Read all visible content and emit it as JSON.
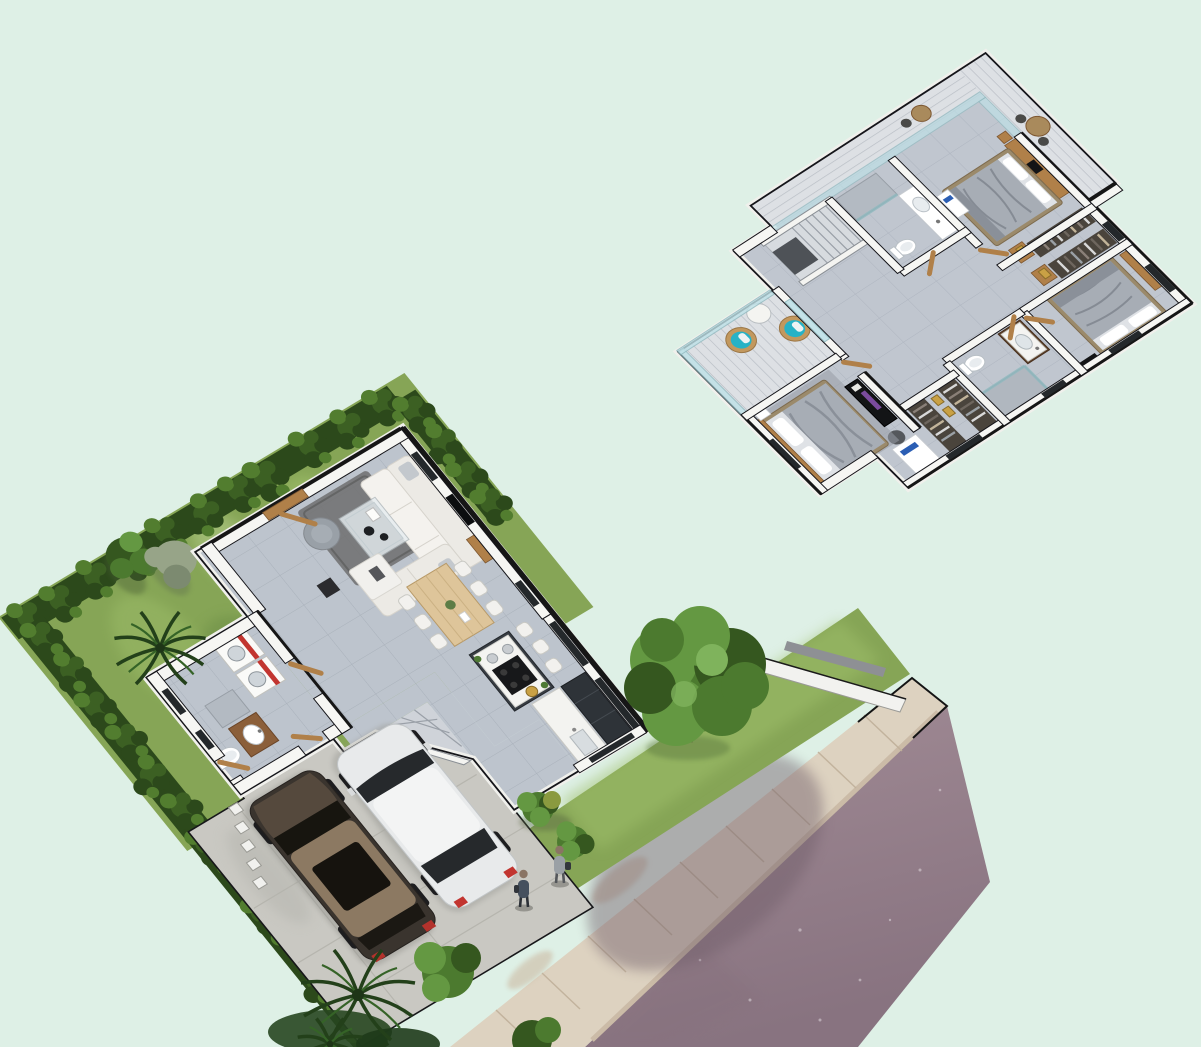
{
  "meta": {
    "title": "Isometric 3D floor plan rendering of a two-storey villa",
    "views": [
      "ground-floor-site-plan",
      "first-floor-plan"
    ]
  },
  "palette": {
    "bg": "#def0e6",
    "road": "#9b8791",
    "roadDark": "#85707c",
    "roadShadow": "#6f5d69",
    "walk": "#ddd2c0",
    "walkJoint": "#c0b09a",
    "curb": "#cbbba7",
    "walkStain": "#cfc2ad",
    "grass": "#86a556",
    "grassL": "#9fbf6a",
    "grassD": "#6a8c44",
    "grassPale": "#b7cf8e",
    "hedge": "#2c491b",
    "hedgeM": "#3c6023",
    "hedgeL": "#527d2f",
    "tree": "#4c7a2f",
    "treeL": "#649842",
    "treeD": "#35571f",
    "treeXL": "#7fb35c",
    "paleTree": "#97a488",
    "paleTreeD": "#7c8a70",
    "palm": "#356327",
    "palmD": "#23401a",
    "tile": "#bdc4cd",
    "tileLine": "#a9b1bb",
    "tileU": "#c0c6cf",
    "tileULine": "#aeb5c0",
    "concrete": "#c9c8c2",
    "concreteLine": "#b2b1aa",
    "wall": "#f6f6f3",
    "cap": "#161616",
    "glassDark": "#24282b",
    "glassTeal": "#bfe2e8",
    "wood": "#b08049",
    "woodD": "#7d5731",
    "sofa": "#eceae5",
    "sofaD": "#d6d3cc",
    "rug": "#6f6f6f",
    "pouf": "#99a0a7",
    "island": "#383d43",
    "applianceD": "#2e3338",
    "counterW": "#f3f3f0",
    "red": "#c23530",
    "gold": "#c9a145",
    "teal": "#27b2c6",
    "rattan": "#c2985e",
    "bedM": "#a7adb5",
    "bedL": "#c8ccd2",
    "bedD": "#81878f",
    "bedW": "#dfe2e6",
    "black": "#131416",
    "purple": "#7b4b9e",
    "monitor": "#2b5eb4",
    "suv": "#3a342e",
    "suvHood": "#55493d",
    "suvRoof": "#8c7962",
    "carW": "#e8eaeb",
    "carGlass": "#26292c",
    "wheel": "#1d1d1f",
    "post": "#f1f1ee",
    "person1": "#45505e",
    "person2": "#9aa0a5",
    "deck": "#dde0e4",
    "deckLine": "#b9bec5"
  },
  "scene": {
    "floors": [
      {
        "name": "ground-floor",
        "rooms": [
          "living-room",
          "dining-area",
          "open-kitchen",
          "laundry",
          "bathroom",
          "patio",
          "driveway",
          "garden"
        ],
        "furniture": [
          "l-shaped-sofa",
          "coffee-table",
          "round-pouf",
          "white-ottoman",
          "area-rug",
          "dining-table",
          "six-dining-chairs",
          "kitchen-island",
          "bar-chairs",
          "cooktop",
          "kitchen-counter",
          "sink-counter",
          "washing-machine",
          "dryer",
          "bathroom-vanity",
          "toilet",
          "wooden-doors"
        ]
      },
      {
        "name": "first-floor",
        "rooms": [
          "master-bedroom",
          "bedroom-2",
          "bedroom-3",
          "bathroom-1",
          "bathroom-2",
          "walk-in-wardrobe",
          "hallway",
          "staircase",
          "balcony",
          "terrace-deck"
        ],
        "furniture": [
          "master-bed",
          "double-bed",
          "double-bed",
          "tv-dresser",
          "desk-with-monitor",
          "clothes-racks",
          "gold-cushion-shelves",
          "teal-rattan-chairs",
          "round-side-table",
          "vanity-units",
          "toilets",
          "shower-enclosures",
          "bathtub-counter",
          "wooden-doors"
        ]
      }
    ],
    "exterior": {
      "vehicles": [
        "dark-bronze-suv",
        "white-crossover"
      ],
      "people": 2,
      "landscape": [
        "perimeter-hedges",
        "lawn",
        "palm-trees",
        "garden-trees",
        "street-tree",
        "shrubs"
      ],
      "street": [
        "asphalt-road",
        "concrete-sidewalk",
        "compound-wall",
        "fence-posts"
      ]
    }
  }
}
